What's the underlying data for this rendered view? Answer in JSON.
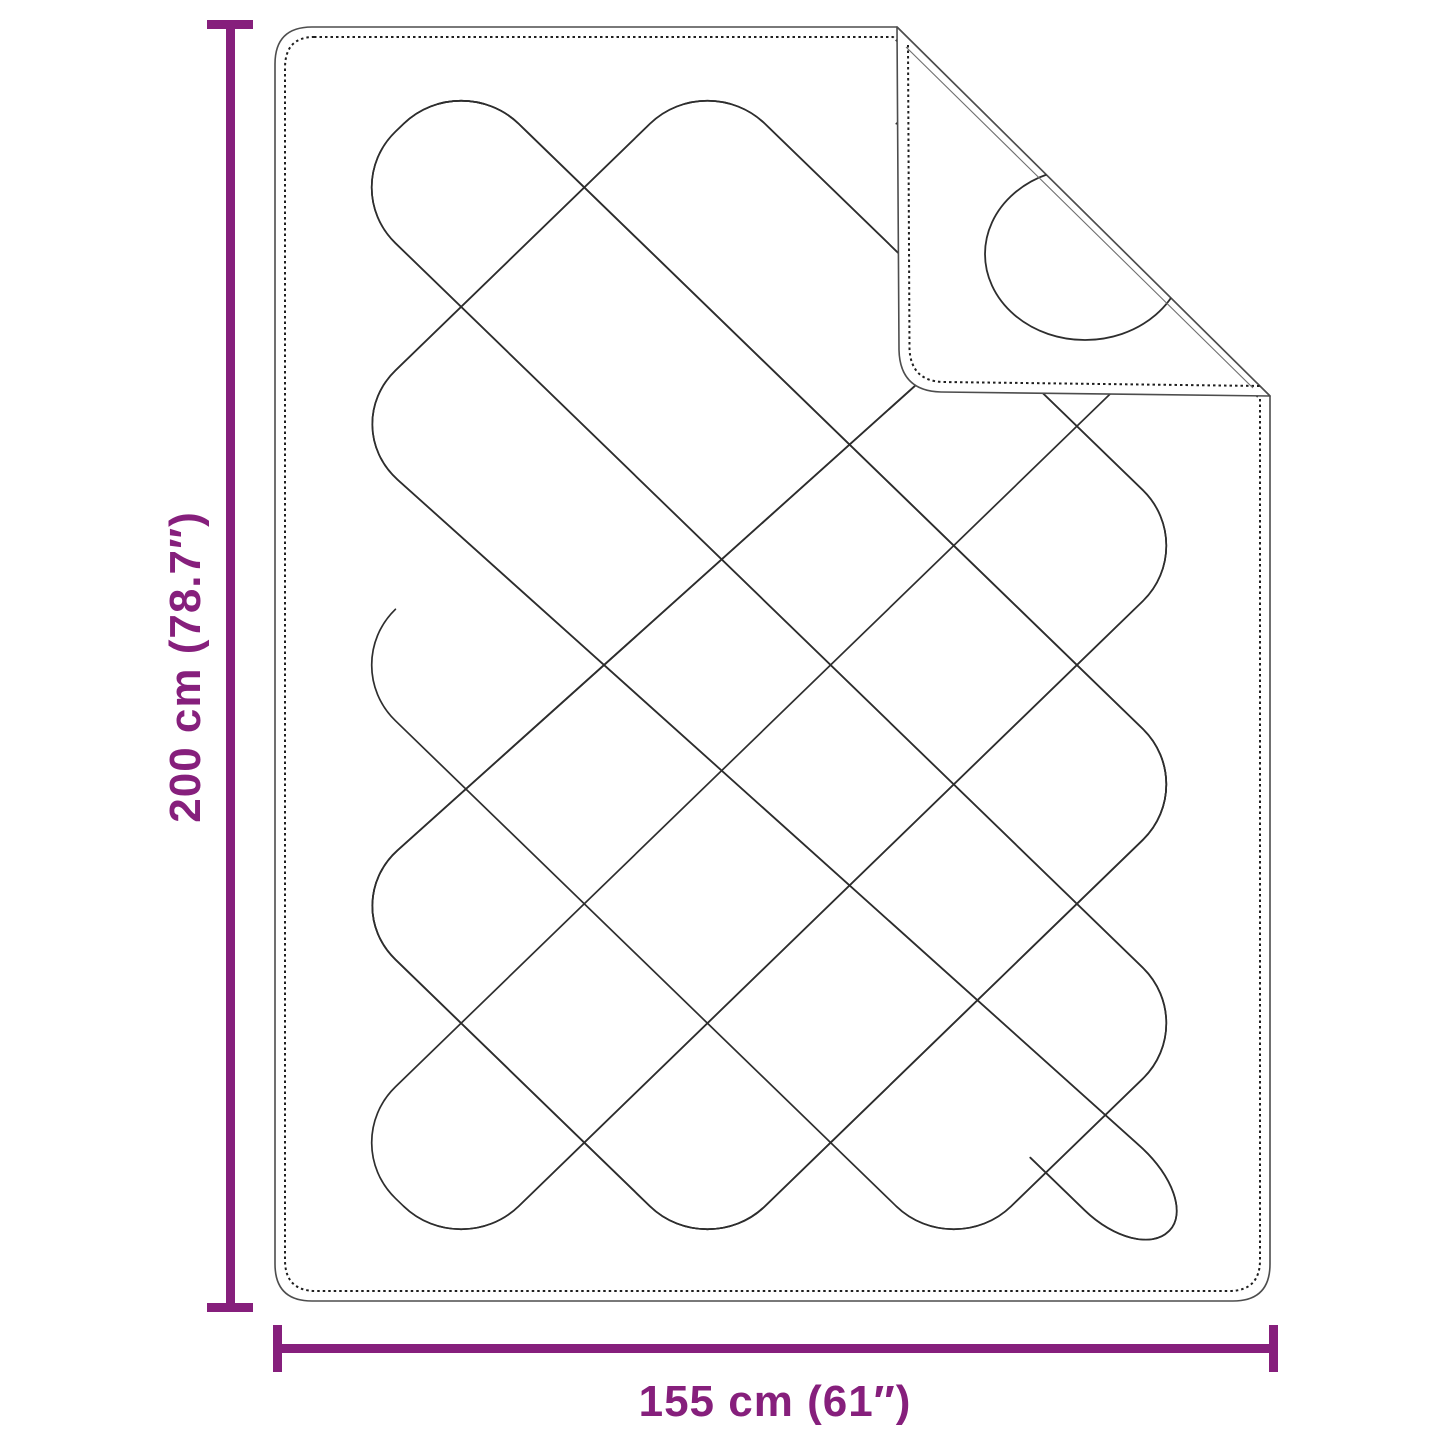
{
  "diagram": {
    "subject": "quilted blanket with folded corner",
    "height_dimension": {
      "label": "200 cm (78.7″)"
    },
    "width_dimension": {
      "label": "155 cm (61″)"
    },
    "colors": {
      "dimension_accent": "#861F7C",
      "outline": "#4d4d4d",
      "stitch": "#1f1f1f",
      "quilt_line": "#2e2e2e"
    }
  }
}
